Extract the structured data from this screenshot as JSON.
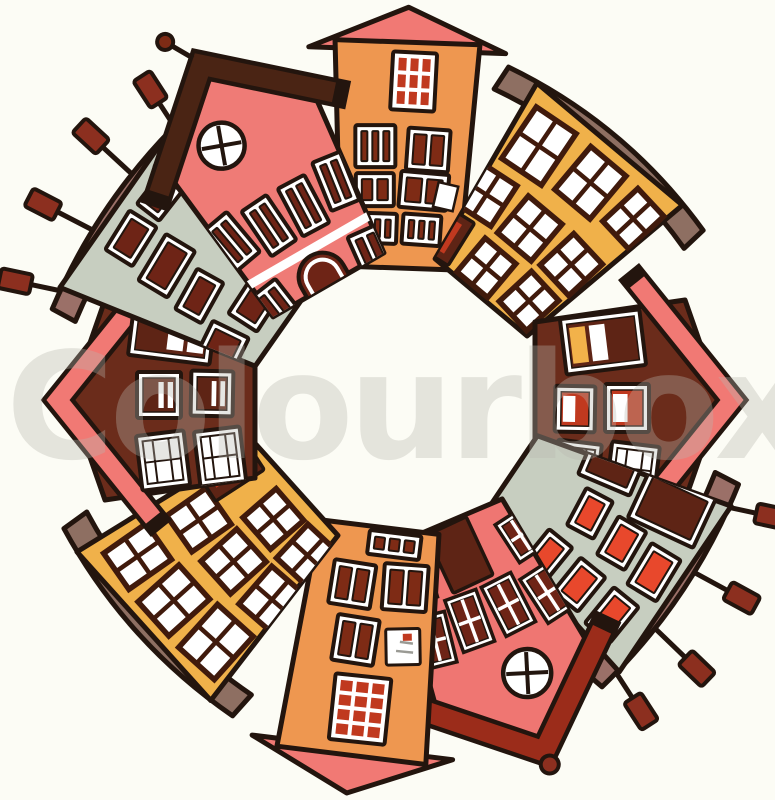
{
  "canvas": {
    "width": 775,
    "height": 800,
    "background": "#FCFCF5",
    "outline": "#23150E",
    "center_x": 395,
    "center_y": 400
  },
  "watermark": {
    "text": "Colourbox",
    "color": "#B9B7AF",
    "opacity": 0.34,
    "font_size": 148,
    "x": 6,
    "baseline_y": 458
  },
  "houses": [
    {
      "id": "house-top-orange-tower",
      "angle": 2,
      "body_color": "#EE9750",
      "roof_color": "#F17974",
      "shape": {
        "kind": "trap",
        "w_top": 145,
        "w_bottom": 118,
        "height": 226,
        "gap": 132
      },
      "roof": {
        "kind": "tri",
        "rise": 35,
        "overhang": 26
      },
      "windows": [
        {
          "k": "grid",
          "x": 58,
          "y": 10,
          "w": 44,
          "h": 58,
          "t": 1,
          "nx": 3,
          "ny": 3,
          "pane": "#C0391F"
        },
        {
          "k": "tall",
          "x": 24,
          "y": 84,
          "w": 40,
          "h": 42,
          "t": -2,
          "n": 3,
          "pane": "#7E2B15"
        },
        {
          "k": "tall",
          "x": 76,
          "y": 86,
          "w": 42,
          "h": 42,
          "t": 2,
          "n": 2,
          "pane": "#7E2B15"
        },
        {
          "k": "tall",
          "x": 26,
          "y": 132,
          "w": 38,
          "h": 33,
          "t": -2,
          "n": 2,
          "pane": "#7E2B15"
        },
        {
          "k": "tallopen",
          "x": 70,
          "y": 130,
          "w": 48,
          "h": 36,
          "t": 3,
          "n": 2,
          "pane": "#7E2B15"
        },
        {
          "k": "tall",
          "x": 30,
          "y": 172,
          "w": 38,
          "h": 30,
          "t": 0,
          "n": 3,
          "pane": "#7E2B15"
        },
        {
          "k": "tall",
          "x": 74,
          "y": 172,
          "w": 38,
          "h": 30,
          "t": 2,
          "n": 3,
          "pane": "#7E2B15"
        }
      ]
    },
    {
      "id": "house-topright-yellow",
      "angle": 40,
      "body_color": "#F0B14A",
      "roof_color": "#8E6F62",
      "shape": {
        "kind": "trap",
        "w_top": 190,
        "w_bottom": 120,
        "height": 200,
        "gap": 134
      },
      "roof": {
        "kind": "slab",
        "rise": 26,
        "thickness": 26,
        "overhang": 32
      },
      "windows": [
        {
          "k": "cross",
          "x": 18,
          "y": 16,
          "w": 48,
          "h": 62,
          "t": -6,
          "frame": "#401A0C"
        },
        {
          "k": "cross",
          "x": 82,
          "y": 14,
          "w": 46,
          "h": 56,
          "t": 0,
          "frame": "#401A0C"
        },
        {
          "k": "cross",
          "x": 142,
          "y": 18,
          "w": 38,
          "h": 48,
          "t": 7,
          "frame": "#401A0C"
        },
        {
          "k": "cross",
          "x": 12,
          "y": 94,
          "w": 42,
          "h": 48,
          "t": -7,
          "frame": "#401A0C"
        },
        {
          "k": "cross",
          "x": 66,
          "y": 92,
          "w": 44,
          "h": 48,
          "t": 0,
          "frame": "#401A0C"
        },
        {
          "k": "cross",
          "x": 122,
          "y": 94,
          "w": 42,
          "h": 46,
          "t": 7,
          "frame": "#401A0C"
        },
        {
          "k": "door-red-slits",
          "x": 6,
          "y": 150,
          "w": 40,
          "h": 50,
          "t": -8
        },
        {
          "k": "cross",
          "x": 60,
          "y": 152,
          "w": 40,
          "h": 44,
          "t": 0,
          "frame": "#401A0C"
        },
        {
          "k": "cross",
          "x": 114,
          "y": 150,
          "w": 40,
          "h": 44,
          "t": 7,
          "frame": "#401A0C"
        }
      ]
    },
    {
      "id": "house-right-maroon",
      "angle": 90,
      "body_color": "#6B2C1B",
      "roof_color": "#F17974",
      "shape": {
        "kind": "pent",
        "w_top": 200,
        "w_bottom": 156,
        "height": 150,
        "gap": 140,
        "apex": 35
      },
      "roof": {
        "kind": "band",
        "thickness": 18,
        "drop": 48,
        "overhang": 18
      },
      "windows": [
        {
          "k": "stripes",
          "x": 14,
          "y": 42,
          "w": 56,
          "h": 80,
          "t": -7,
          "base": "#5E2415",
          "stripes": [
            "#F2B24A",
            "#FFFFFF"
          ]
        },
        {
          "k": "stripes",
          "x": 84,
          "y": 36,
          "w": 48,
          "h": 44,
          "t": 0,
          "base": "#C0391F",
          "stripes": [
            "#FFFFFF"
          ]
        },
        {
          "k": "stripes",
          "x": 86,
          "y": 90,
          "w": 46,
          "h": 40,
          "t": 1,
          "base": "#C0391F",
          "stripes": [
            "#FFFFFF"
          ]
        },
        {
          "k": "panes6",
          "x": 144,
          "y": 28,
          "w": 50,
          "h": 48,
          "t": 7
        },
        {
          "k": "panes6",
          "x": 142,
          "y": 86,
          "w": 50,
          "h": 44,
          "t": 7
        }
      ]
    },
    {
      "id": "house-bottomright-green",
      "angle": 124,
      "body_color": "#C7CEC0",
      "roof_color": "#9B7068",
      "shape": {
        "kind": "trap",
        "w_top": 200,
        "w_bottom": 100,
        "height": 200,
        "gap": 138
      },
      "roof": {
        "kind": "slab",
        "rise": 20,
        "thickness": 26,
        "overhang": 22
      },
      "chimney_color": "#8C2F1F",
      "chimney_fan": 55,
      "chimneys": [
        {
          "f": 0.1,
          "len": 34
        },
        {
          "f": 0.4,
          "len": 44
        },
        {
          "f": 0.68,
          "len": 48
        },
        {
          "f": 0.92,
          "len": 36
        }
      ],
      "windows": [
        {
          "k": "redpane",
          "x": 8,
          "y": 12,
          "w": 54,
          "h": 72,
          "t": -9,
          "pane": "#5E2415"
        },
        {
          "k": "redpane",
          "x": 6,
          "y": 94,
          "w": 48,
          "h": 56,
          "t": -11,
          "pane": "#5E2415"
        },
        {
          "k": "redpane",
          "x": 74,
          "y": 10,
          "w": 48,
          "h": 34,
          "t": -3,
          "pane": "#E8482C"
        },
        {
          "k": "redpane",
          "x": 70,
          "y": 54,
          "w": 44,
          "h": 32,
          "t": -4,
          "pane": "#E8482C"
        },
        {
          "k": "redpane",
          "x": 64,
          "y": 98,
          "w": 42,
          "h": 30,
          "t": -6,
          "pane": "#E8482C"
        },
        {
          "k": "redpane",
          "x": 134,
          "y": 22,
          "w": 46,
          "h": 32,
          "t": 5,
          "pane": "#E8482C"
        },
        {
          "k": "redpane",
          "x": 128,
          "y": 66,
          "w": 44,
          "h": 32,
          "t": 5,
          "pane": "#E8482C"
        },
        {
          "k": "redpane",
          "x": 122,
          "y": 110,
          "w": 44,
          "h": 30,
          "t": 5,
          "pane": "#E8482C"
        }
      ]
    },
    {
      "id": "house-bottom-pink",
      "angle": 157,
      "body_color": "#EF7672",
      "roof_color": "#9B2C1A",
      "shape": {
        "kind": "pent",
        "w_top": 170,
        "w_bottom": 120,
        "height": 185,
        "gap": 133,
        "apex": 52
      },
      "roof": {
        "kind": "band",
        "thickness": 20,
        "drop": 26,
        "overhang": 16,
        "finial": "ball",
        "finial_color": "#8C2F1F"
      },
      "windows": [
        {
          "k": "round",
          "x": 70,
          "y": 15,
          "r": 24,
          "t": 20
        },
        {
          "k": "cross2",
          "x": 4,
          "y": 55,
          "w": 32,
          "h": 52,
          "t": -10,
          "pane": "#6E2416"
        },
        {
          "k": "cross2",
          "x": 44,
          "y": 58,
          "w": 33,
          "h": 55,
          "t": -4,
          "pane": "#6E2416"
        },
        {
          "k": "cross2",
          "x": 86,
          "y": 58,
          "w": 33,
          "h": 55,
          "t": 3,
          "pane": "#6E2416"
        },
        {
          "k": "cross2",
          "x": 126,
          "y": 55,
          "w": 32,
          "h": 52,
          "t": 9,
          "pane": "#6E2416"
        },
        {
          "k": "cross2",
          "x": 6,
          "y": 122,
          "w": 32,
          "h": 45,
          "t": -10,
          "pane": "#6E2416"
        },
        {
          "k": "door-plain",
          "x": 64,
          "y": 118,
          "w": 44,
          "h": 64,
          "t": -2,
          "pane": "#5E2415"
        },
        {
          "k": "cross2",
          "x": 120,
          "y": 122,
          "w": 32,
          "h": 45,
          "t": 7,
          "pane": "#6E2416"
        }
      ]
    },
    {
      "id": "house-bottom-orange-tower",
      "angle": 187,
      "body_color": "#EE9750",
      "roof_color": "#F17974",
      "shape": {
        "kind": "trap",
        "w_top": 150,
        "w_bottom": 120,
        "height": 230,
        "gap": 128
      },
      "roof": {
        "kind": "tri",
        "rise": 38,
        "overhang": 26
      },
      "windows": [
        {
          "k": "grid",
          "x": 44,
          "y": 14,
          "w": 56,
          "h": 66,
          "t": -1,
          "nx": 3,
          "ny": 4,
          "pane": "#C0391F"
        },
        {
          "k": "note",
          "x": 20,
          "y": 96,
          "w": 34,
          "h": 36,
          "t": -8
        },
        {
          "k": "tall",
          "x": 64,
          "y": 92,
          "w": 42,
          "h": 46,
          "t": 2,
          "n": 2,
          "pane": "#7E2B15"
        },
        {
          "k": "tall",
          "x": 20,
          "y": 150,
          "w": 44,
          "h": 46,
          "t": -3,
          "n": 2,
          "pane": "#7E2B15"
        },
        {
          "k": "tall",
          "x": 74,
          "y": 148,
          "w": 42,
          "h": 44,
          "t": 2,
          "n": 2,
          "pane": "#7E2B15"
        },
        {
          "k": "tall",
          "x": 32,
          "y": 202,
          "w": 52,
          "h": 24,
          "t": 0,
          "n": 3,
          "pane": "#7E2B15"
        }
      ]
    },
    {
      "id": "house-bottomleft-yellow",
      "angle": 228,
      "body_color": "#F0B14A",
      "roof_color": "#8E6F62",
      "shape": {
        "kind": "trap",
        "w_top": 200,
        "w_bottom": 125,
        "height": 205,
        "gap": 133
      },
      "roof": {
        "kind": "slab",
        "rise": 24,
        "thickness": 28,
        "overhang": 26
      },
      "windows": [
        {
          "k": "cross",
          "x": 16,
          "y": 14,
          "w": 48,
          "h": 58,
          "t": -6,
          "frame": "#401A0C"
        },
        {
          "k": "cross",
          "x": 76,
          "y": 12,
          "w": 46,
          "h": 55,
          "t": 0,
          "frame": "#401A0C"
        },
        {
          "k": "cross",
          "x": 134,
          "y": 16,
          "w": 44,
          "h": 52,
          "t": 7,
          "frame": "#401A0C"
        },
        {
          "k": "cross",
          "x": 12,
          "y": 88,
          "w": 44,
          "h": 50,
          "t": -7,
          "frame": "#401A0C"
        },
        {
          "k": "cross",
          "x": 66,
          "y": 86,
          "w": 44,
          "h": 48,
          "t": 0,
          "frame": "#401A0C"
        },
        {
          "k": "cross",
          "x": 120,
          "y": 88,
          "w": 44,
          "h": 48,
          "t": 7,
          "frame": "#401A0C"
        },
        {
          "k": "cross",
          "x": 22,
          "y": 146,
          "w": 42,
          "h": 46,
          "t": -5,
          "frame": "#401A0C"
        },
        {
          "k": "cross",
          "x": 72,
          "y": 146,
          "w": 42,
          "h": 44,
          "t": 1,
          "frame": "#401A0C"
        },
        {
          "k": "door-red-slits",
          "x": 140,
          "y": 140,
          "w": 44,
          "h": 58,
          "t": 9
        }
      ]
    },
    {
      "id": "house-left-maroon",
      "angle": 270,
      "body_color": "#6B2C1B",
      "roof_color": "#F17974",
      "shape": {
        "kind": "pent",
        "w_top": 200,
        "w_bottom": 156,
        "height": 150,
        "gap": 140,
        "apex": 35
      },
      "roof": {
        "kind": "band",
        "thickness": 18,
        "drop": 48,
        "overhang": 18
      },
      "windows": [
        {
          "k": "panes6",
          "x": 12,
          "y": 34,
          "w": 55,
          "h": 48,
          "t": -7
        },
        {
          "k": "panes6",
          "x": 16,
          "y": 92,
          "w": 55,
          "h": 46,
          "t": -7
        },
        {
          "k": "stripes",
          "x": 82,
          "y": 32,
          "w": 46,
          "h": 44,
          "t": 0,
          "base": "#5E2415",
          "stripes": [
            "#FFFFFF",
            "#FFFFFF"
          ]
        },
        {
          "k": "stripes",
          "x": 84,
          "y": 86,
          "w": 45,
          "h": 42,
          "t": 1,
          "base": "#5E2415",
          "stripes": [
            "#FFFFFF",
            "#FFFFFF"
          ]
        },
        {
          "k": "stripes",
          "x": 140,
          "y": 26,
          "w": 54,
          "h": 82,
          "t": 7,
          "base": "#5E2415",
          "stripes": [
            "#FFFFFF",
            "#FFFFFF"
          ]
        }
      ]
    },
    {
      "id": "house-topleft-green",
      "angle": 305,
      "body_color": "#C7CEC0",
      "roof_color": "#9B7068",
      "shape": {
        "kind": "trap",
        "w_top": 200,
        "w_bottom": 105,
        "height": 205,
        "gap": 134
      },
      "roof": {
        "kind": "slab",
        "rise": 20,
        "thickness": 26,
        "overhang": 22
      },
      "chimney_color": "#8C2F1F",
      "chimney_fan": 55,
      "chimneys": [
        {
          "f": 0.08,
          "len": 36
        },
        {
          "f": 0.36,
          "len": 46
        },
        {
          "f": 0.64,
          "len": 46
        },
        {
          "f": 0.9,
          "len": 34
        }
      ],
      "windows": [
        {
          "k": "redpane",
          "x": 58,
          "y": 14,
          "w": 46,
          "h": 32,
          "t": -3,
          "pane": "#6E2416"
        },
        {
          "k": "redpane",
          "x": 112,
          "y": 16,
          "w": 38,
          "h": 28,
          "t": 3,
          "pane": "#6E2416"
        },
        {
          "k": "redpane",
          "x": 52,
          "y": 58,
          "w": 54,
          "h": 34,
          "t": -4,
          "pane": "#6E2416"
        },
        {
          "k": "redpane",
          "x": 50,
          "y": 104,
          "w": 46,
          "h": 30,
          "t": -6,
          "pane": "#6E2416"
        },
        {
          "k": "redpane",
          "x": 148,
          "y": 10,
          "w": 44,
          "h": 76,
          "t": 7,
          "pane": "#6E2416"
        },
        {
          "k": "redpane",
          "x": 146,
          "y": 98,
          "w": 44,
          "h": 64,
          "t": 8,
          "pane": "#6E2416"
        },
        {
          "k": "redpane",
          "x": 14,
          "y": 148,
          "w": 50,
          "h": 40,
          "t": -9,
          "pane": "#6E2416"
        },
        {
          "k": "redpane",
          "x": 76,
          "y": 152,
          "w": 40,
          "h": 34,
          "t": -2,
          "pane": "#6E2416"
        }
      ]
    },
    {
      "id": "house-topleft-pink",
      "angle": 330,
      "body_color": "#EF7B76",
      "roof_color": "#4A2414",
      "shape": {
        "kind": "pent",
        "w_top": 170,
        "w_bottom": 128,
        "height": 190,
        "gap": 133,
        "apex": 52
      },
      "roof": {
        "kind": "band",
        "thickness": 20,
        "drop": 26,
        "overhang": 16,
        "finial": "antenna",
        "finial_color": "#7E2B15"
      },
      "windows": [
        {
          "k": "round",
          "x": 62,
          "y": 16,
          "r": 23,
          "t": 20
        },
        {
          "k": "tall",
          "x": 8,
          "y": 78,
          "w": 30,
          "h": 52,
          "t": -10,
          "n": 2,
          "pane": "#6E2416"
        },
        {
          "k": "tall",
          "x": 48,
          "y": 82,
          "w": 30,
          "h": 54,
          "t": -4,
          "n": 2,
          "pane": "#6E2416"
        },
        {
          "k": "tall",
          "x": 88,
          "y": 82,
          "w": 30,
          "h": 54,
          "t": 2,
          "n": 2,
          "pane": "#6E2416"
        },
        {
          "k": "tall",
          "x": 128,
          "y": 78,
          "w": 30,
          "h": 52,
          "t": 8,
          "n": 2,
          "pane": "#6E2416"
        },
        {
          "k": "trim",
          "x": 4,
          "y": 146,
          "w": 162,
          "h": 9
        },
        {
          "k": "tall",
          "x": 14,
          "y": 160,
          "w": 32,
          "h": 56,
          "t": -8,
          "n": 2,
          "pane": "#6E2416"
        },
        {
          "k": "arch",
          "x": 60,
          "y": 156,
          "w": 48,
          "h": 62,
          "t": 0,
          "pane": "#6E2416"
        },
        {
          "k": "tall",
          "x": 122,
          "y": 160,
          "w": 32,
          "h": 56,
          "t": 6,
          "n": 2,
          "pane": "#6E2416"
        }
      ]
    }
  ]
}
